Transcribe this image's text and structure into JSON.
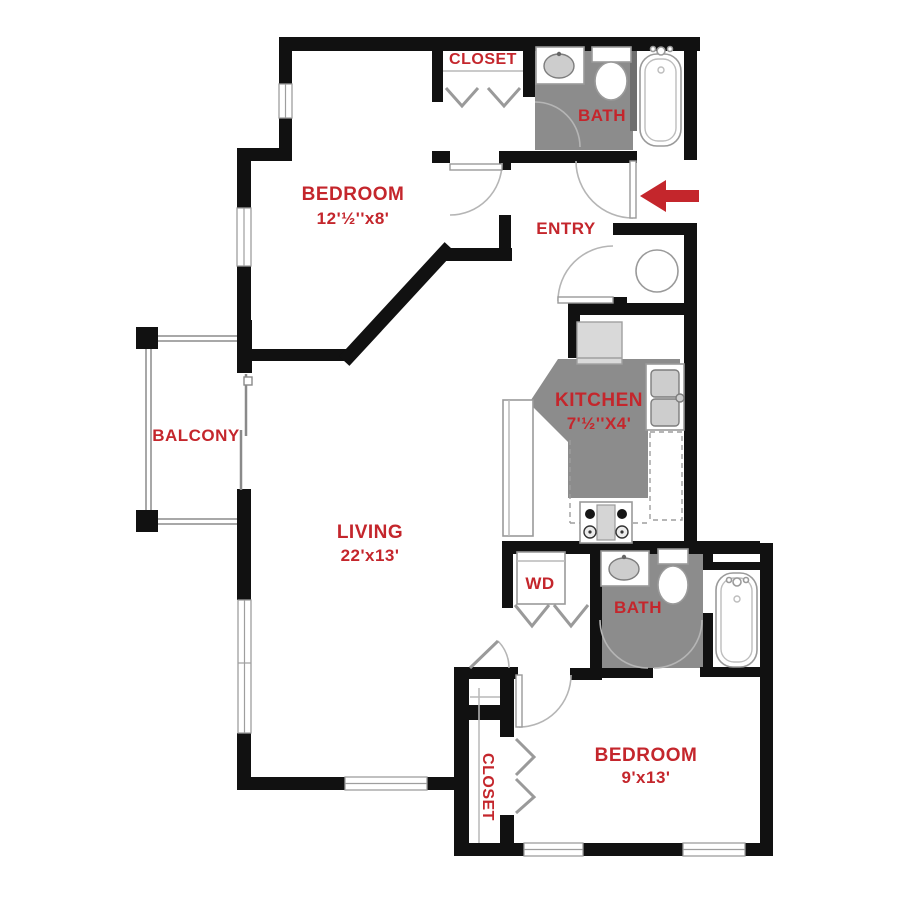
{
  "plan_title": "Apartment floor plan",
  "colors": {
    "wall": "#111111",
    "room_floor_gray": "#8c8c8c",
    "label_red": "#c4262c",
    "fixture_light_gray": "#d9d9d9"
  },
  "rooms": {
    "bedroom_top": {
      "label": "BEDROOM",
      "dims": "12'½''x8'"
    },
    "closet_top": {
      "label": "CLOSET"
    },
    "bath_top": {
      "label": "BATH"
    },
    "entry": {
      "label": "ENTRY"
    },
    "kitchen": {
      "label": "KITCHEN",
      "dims": "7'½''X4'"
    },
    "balcony": {
      "label": "BALCONY"
    },
    "living": {
      "label": "LIVING",
      "dims": "22'x13'"
    },
    "laundry": {
      "label": "WD"
    },
    "bath_bottom": {
      "label": "BATH"
    },
    "bedroom_bottom": {
      "label": "BEDROOM",
      "dims": "9'x13'"
    },
    "closet_bottom": {
      "label": "CLOSET"
    }
  },
  "icons": [
    "entry-arrow-icon",
    "bathtub-icon",
    "toilet-icon",
    "sink-icon",
    "refrigerator-icon",
    "range-icon",
    "kitchen-sink-icon",
    "washer-dryer-icon",
    "water-heater-icon",
    "bifold-door-icon",
    "door-swing-icon",
    "window-icon",
    "sliding-door-icon",
    "balcony-railing-icon"
  ]
}
